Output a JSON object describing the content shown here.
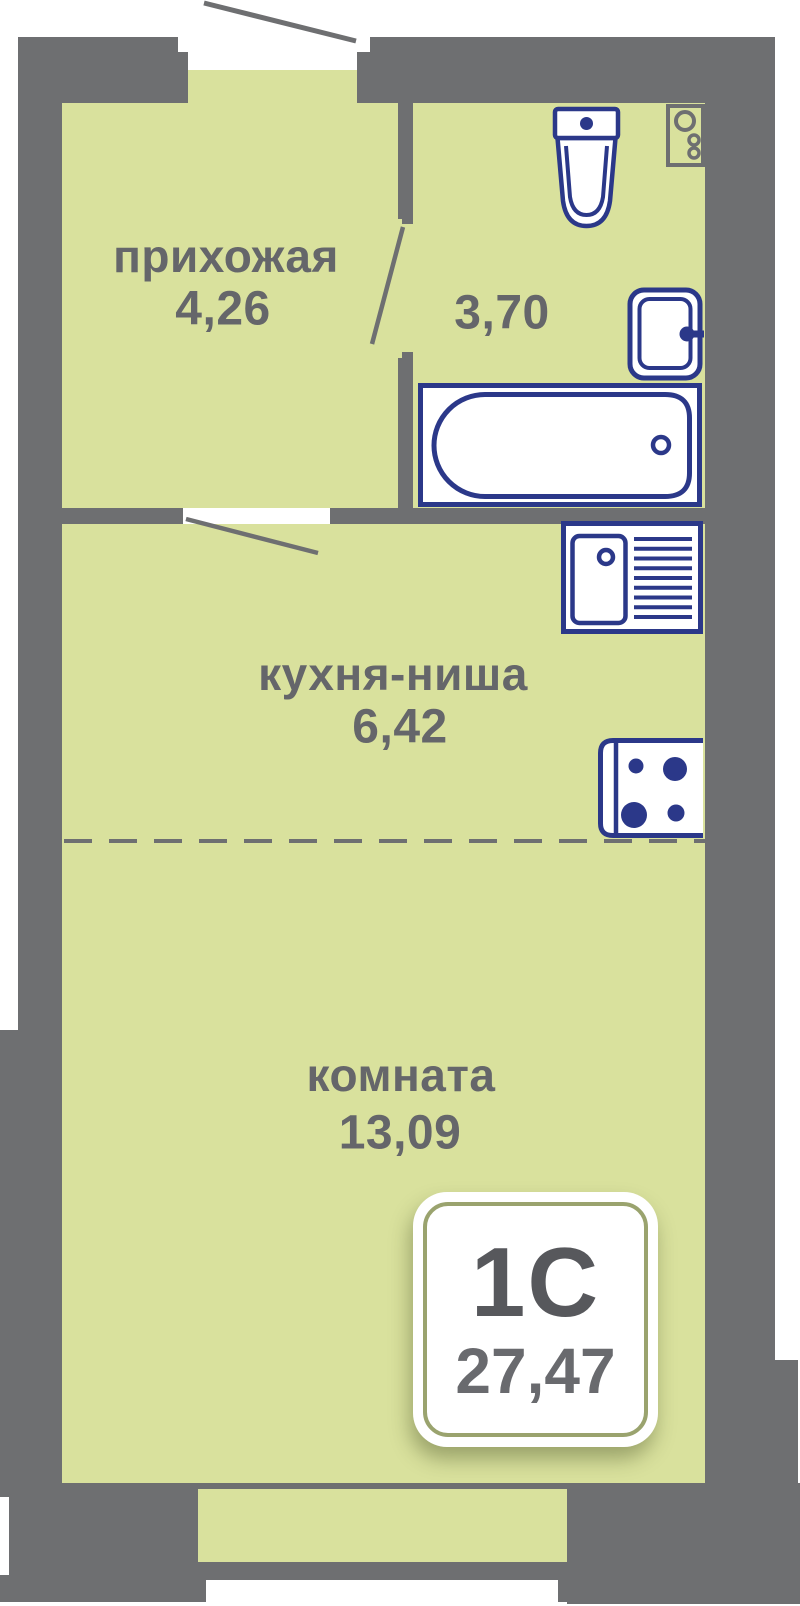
{
  "plan": {
    "rooms": {
      "hallway": {
        "label": "прихожая",
        "area": "4,26"
      },
      "bathroom": {
        "area": "3,70"
      },
      "kitchen": {
        "label": "кухня-ниша",
        "area": "6,42"
      },
      "room": {
        "label": "комната",
        "area": "13,09"
      }
    },
    "badge": {
      "type": "1С",
      "total_area": "27,47"
    },
    "fixtures": [
      "toilet",
      "washing-machine",
      "washbasin",
      "bathtub",
      "kitchen-sink",
      "stove",
      "window"
    ]
  },
  "colors": {
    "floor": "#d9e19d",
    "wall": "#6e6f71",
    "fixture_blue": "#2b3889",
    "label_text": "#65666a",
    "badge_ring": "#9aa36e",
    "badge_type_text": "#57585c",
    "badge_area_text": "#696a6e"
  }
}
